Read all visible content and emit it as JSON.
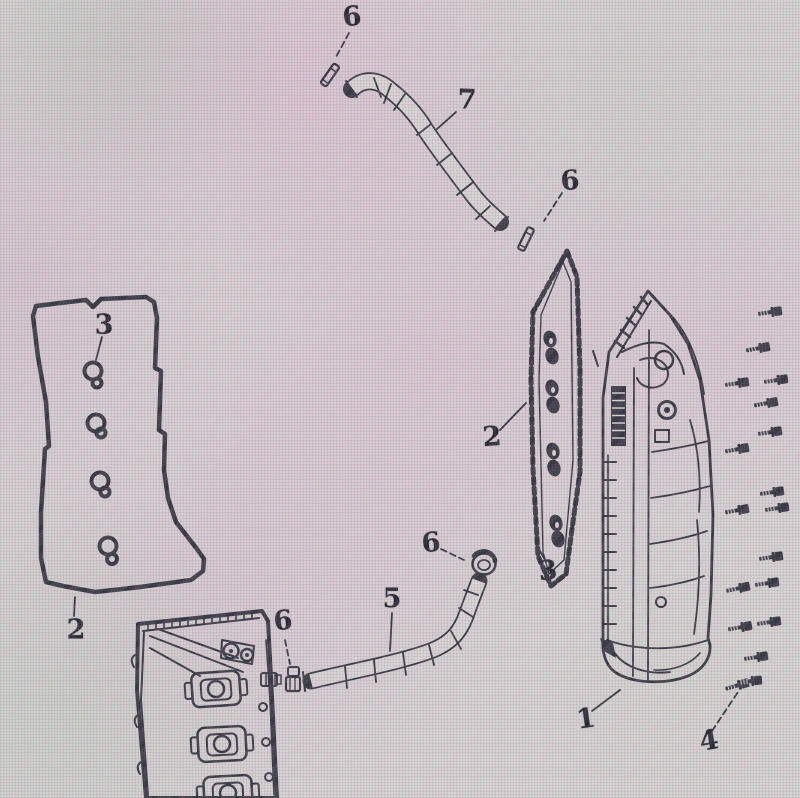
{
  "colors": {
    "ink": "#2c2c3a",
    "label": "#1b1b29",
    "screen_base": "#d7d1d3",
    "tint_pink": "#deaad0",
    "tint_green": "#aec4ae"
  },
  "callouts": [
    {
      "part": "hose-clamp-pin-upper",
      "label": "6"
    },
    {
      "part": "vent-hose-upper",
      "label": "7"
    },
    {
      "part": "hose-clamp-pin-lower",
      "label": "6"
    },
    {
      "part": "grommet-left-gasket",
      "label": "3"
    },
    {
      "part": "valve-cover-gasket",
      "label": "2"
    },
    {
      "part": "side-cover-gasket",
      "label": "2"
    },
    {
      "part": "grommet-right-gasket",
      "label": "3"
    },
    {
      "part": "cylinder-head-cover",
      "label": "1"
    },
    {
      "part": "bolt-set",
      "label": "4"
    },
    {
      "part": "water-hose-lower",
      "label": "5"
    },
    {
      "part": "hose-clamp-ring",
      "label": "6"
    },
    {
      "part": "hose-clamp-small",
      "label": "6"
    }
  ]
}
